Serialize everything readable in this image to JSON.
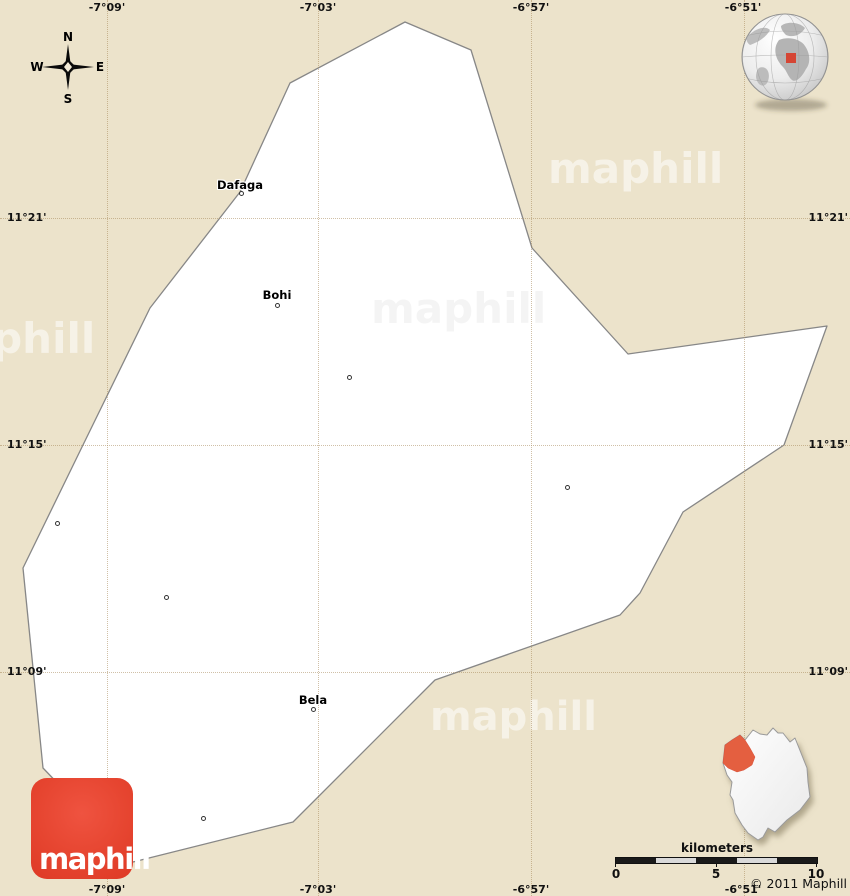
{
  "map": {
    "region_towns": [
      {
        "name": "Dafaga"
      },
      {
        "name": "Bohi"
      },
      {
        "name": "Bela"
      }
    ],
    "watermark_text": "maphill"
  },
  "grid": {
    "meridians": [
      "-7°09'",
      "-7°03'",
      "-6°57'",
      "-6°51'"
    ],
    "parallels": [
      "11°21'",
      "11°15'",
      "11°09'"
    ]
  },
  "compass": {
    "north": "N",
    "east": "E",
    "south": "S",
    "west": "W"
  },
  "logo": {
    "text": "maphill"
  },
  "scale": {
    "title": "kilometers",
    "ticks": [
      "0",
      "5",
      "10"
    ]
  },
  "copyright": "© 2011 Maphill",
  "colors": {
    "background_beige": "#ece3cb",
    "region_fill": "#ffffff",
    "region_border": "#878787",
    "logo_red": "#e64530",
    "locator_highlight": "#e45f41",
    "globe_marker_red": "#d54534",
    "gridline": "#c9b793"
  }
}
